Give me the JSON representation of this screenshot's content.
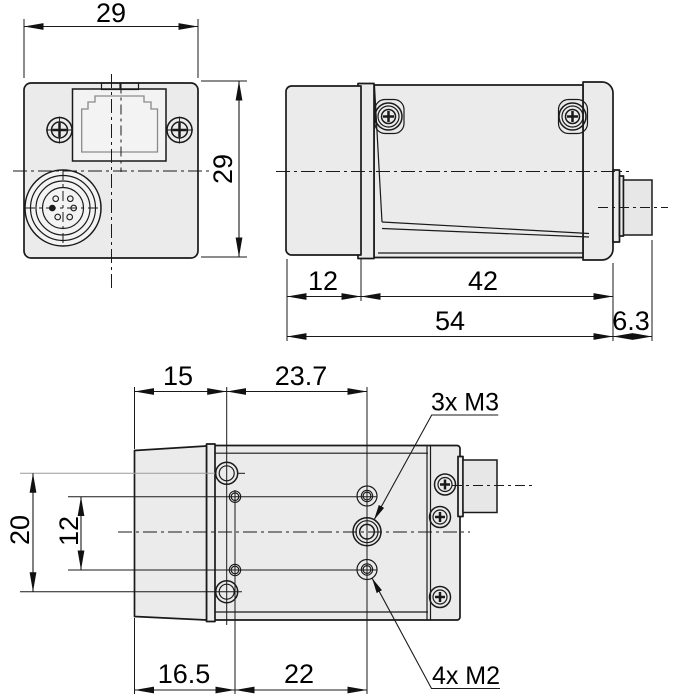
{
  "colors": {
    "background": "#ffffff",
    "body_fill": "#ebebeb",
    "recess_fill": "#f3f3f3",
    "connector_fill": "#e7e7e7",
    "line": "#1a1a1a",
    "gray_line": "#9c9c9c",
    "text": "#000000"
  },
  "views": {
    "rear": {
      "dim_width_mm": "29",
      "dim_height_mm": "29"
    },
    "side": {
      "dim_lens_mm": "12",
      "dim_body_mm": "42",
      "dim_overall_mm": "54",
      "dim_connector_mm": "6.3"
    },
    "bottom": {
      "dim_top_front_mm": "15",
      "dim_top_span_mm": "23.7",
      "dim_left_outer_mm": "20",
      "dim_left_inner_mm": "12",
      "dim_bottom_front_mm": "16.5",
      "dim_bottom_span_mm": "22",
      "label_m3": "3x M3",
      "label_m2": "4x M2"
    }
  }
}
